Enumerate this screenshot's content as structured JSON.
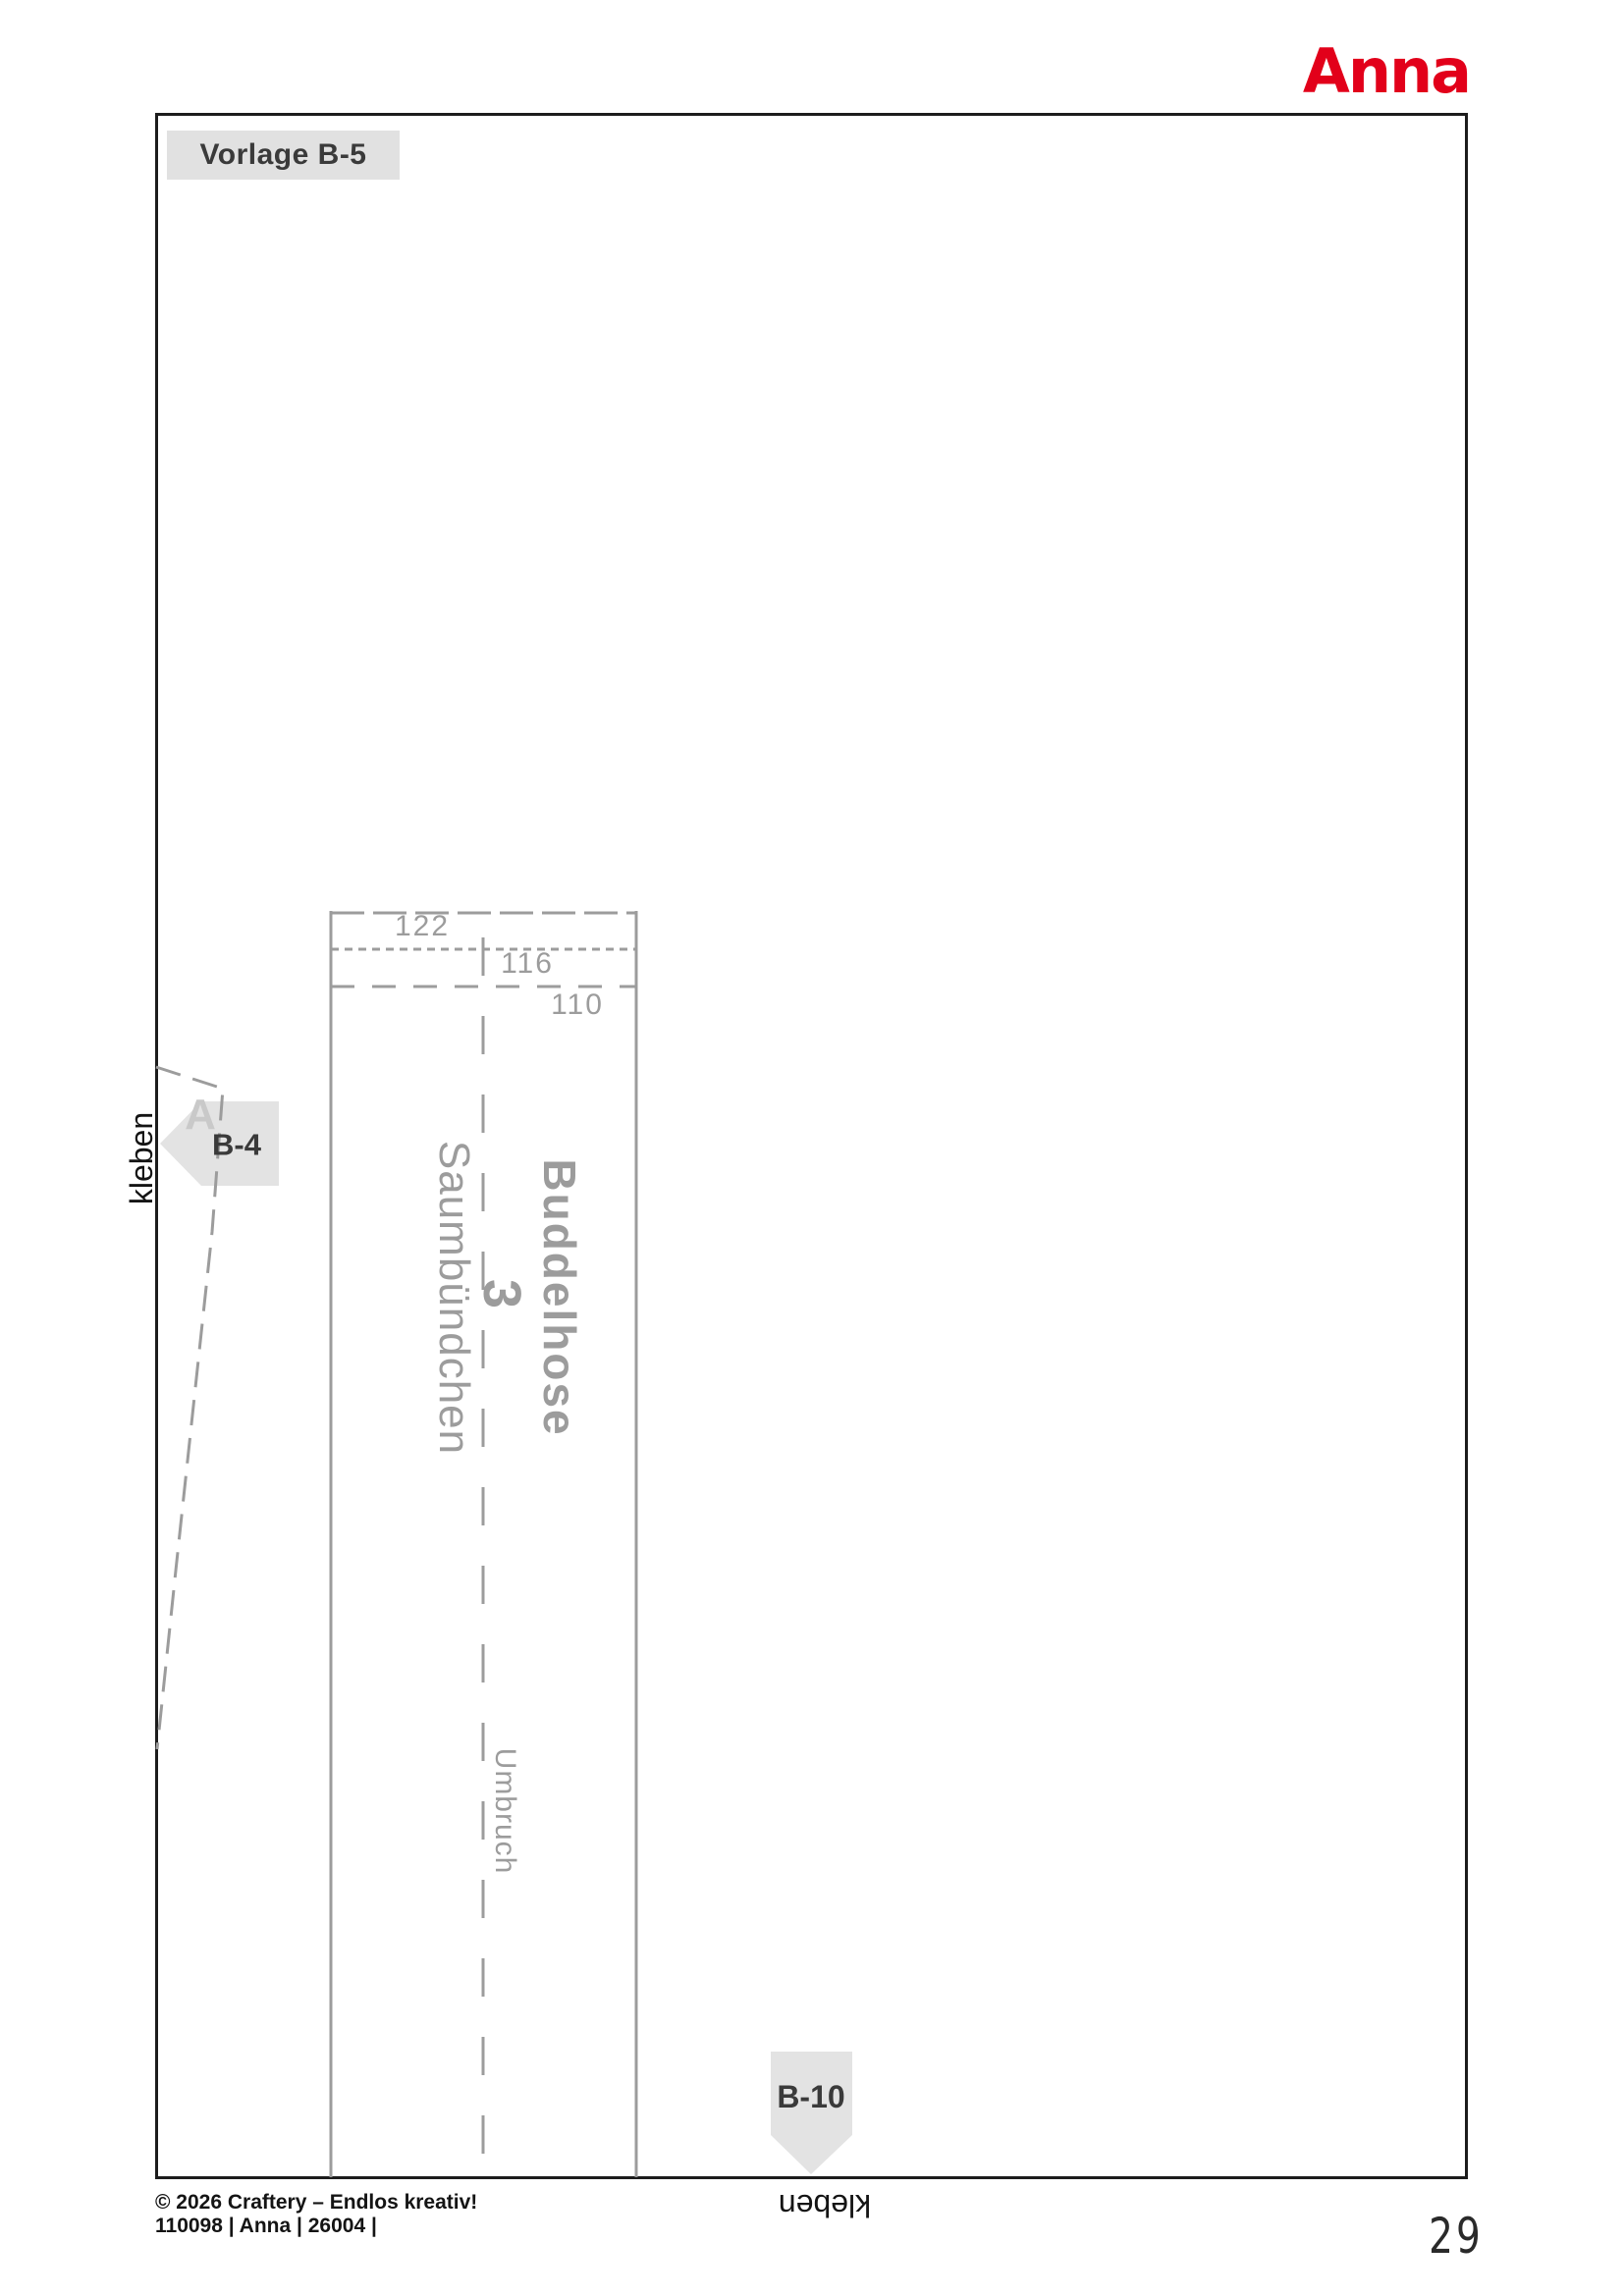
{
  "colors": {
    "brand_red": "#e2001a",
    "pattern_gray": "#9c9c9c",
    "label_box_gray": "#e1e1e1",
    "label_text_dark": "#3a3a3a",
    "frame_black": "#1c1c1c",
    "ghost_letter_gray": "#c9c9c9"
  },
  "header": {
    "brand_logo": "Anna",
    "template_label": "Vorlage B-5"
  },
  "pattern_piece": {
    "garment_name": "Buddelhose",
    "piece_number": "3",
    "piece_name": "Saumbündchen",
    "fold_line_label": "Umbruch",
    "size_labels": [
      "122",
      "116",
      "110"
    ]
  },
  "connectors": {
    "left_label": "B-4",
    "left_ghost_letter": "A",
    "left_glue_text": "kleben",
    "bottom_label": "B-10",
    "bottom_glue_text": "kleben"
  },
  "footer": {
    "copyright": "© 2026 Craftery – Endlos kreativ!",
    "issue_info": "110098 | Anna | 26004 |",
    "page_number": "29"
  }
}
